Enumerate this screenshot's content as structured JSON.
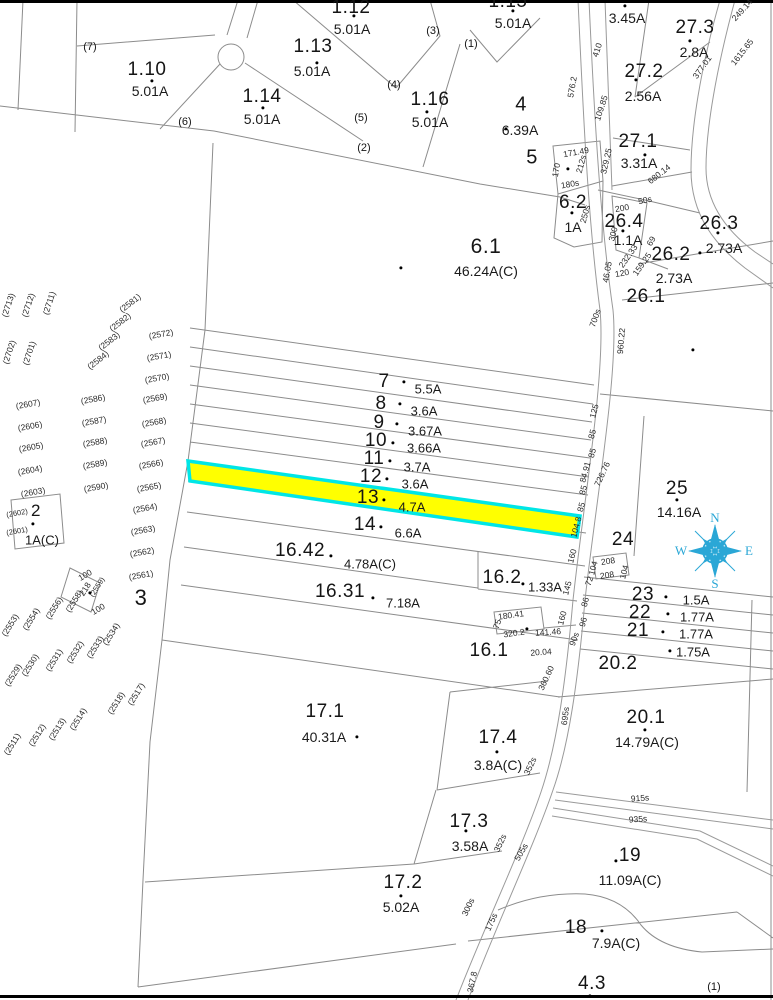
{
  "colors": {
    "highlight_fill": "#ffff00",
    "highlight_stroke": "#00e6e6",
    "compass": "#2aa7d6",
    "line": "#8c8c8c",
    "frame": "#000000"
  },
  "highlight": {
    "parcel": "13",
    "acreage": "4.7A"
  },
  "compass": {
    "n": "N",
    "e": "E",
    "s": "S",
    "w": "W"
  },
  "labels": {
    "parcels": [
      {
        "t": "1.10",
        "x": 147,
        "y": 70
      },
      {
        "t": "1.13",
        "x": 313,
        "y": 47
      },
      {
        "t": "1.12",
        "x": 351,
        "y": 8
      },
      {
        "t": "1.14",
        "x": 262,
        "y": 97
      },
      {
        "t": "1.16",
        "x": 430,
        "y": 100
      },
      {
        "t": "1.15",
        "x": 508,
        "y": 2
      },
      {
        "t": "4",
        "x": 521,
        "y": 105,
        "s": 20
      },
      {
        "t": "5",
        "x": 532,
        "y": 158,
        "s": 20
      },
      {
        "t": "27.3",
        "x": 695,
        "y": 28
      },
      {
        "t": "27.2",
        "x": 644,
        "y": 72
      },
      {
        "t": "27.1",
        "x": 638,
        "y": 142
      },
      {
        "t": "6.2",
        "x": 573,
        "y": 203
      },
      {
        "t": "26.4",
        "x": 624,
        "y": 222
      },
      {
        "t": "26.3",
        "x": 719,
        "y": 224
      },
      {
        "t": "26.2",
        "x": 671,
        "y": 255
      },
      {
        "t": "26.1",
        "x": 646,
        "y": 297
      },
      {
        "t": "6.1",
        "x": 486,
        "y": 247,
        "s": 21
      },
      {
        "t": "7",
        "x": 384,
        "y": 382
      },
      {
        "t": "8",
        "x": 381,
        "y": 404
      },
      {
        "t": "9",
        "x": 379,
        "y": 423
      },
      {
        "t": "10",
        "x": 376,
        "y": 441
      },
      {
        "t": "11",
        "x": 374,
        "y": 459
      },
      {
        "t": "12",
        "x": 371,
        "y": 477
      },
      {
        "t": "13",
        "x": 368,
        "y": 498
      },
      {
        "t": "14",
        "x": 365,
        "y": 525
      },
      {
        "t": "16.42",
        "x": 300,
        "y": 551
      },
      {
        "t": "16.31",
        "x": 340,
        "y": 592
      },
      {
        "t": "16.2",
        "x": 502,
        "y": 578
      },
      {
        "t": "16.1",
        "x": 489,
        "y": 651
      },
      {
        "t": "25",
        "x": 677,
        "y": 489
      },
      {
        "t": "24",
        "x": 623,
        "y": 540
      },
      {
        "t": "23",
        "x": 643,
        "y": 595
      },
      {
        "t": "22",
        "x": 640,
        "y": 613
      },
      {
        "t": "21",
        "x": 638,
        "y": 631
      },
      {
        "t": "20.2",
        "x": 618,
        "y": 664
      },
      {
        "t": "20.1",
        "x": 646,
        "y": 718
      },
      {
        "t": "17.1",
        "x": 325,
        "y": 712
      },
      {
        "t": "17.4",
        "x": 498,
        "y": 738
      },
      {
        "t": "17.3",
        "x": 469,
        "y": 822
      },
      {
        "t": "17.2",
        "x": 403,
        "y": 883
      },
      {
        "t": "19",
        "x": 630,
        "y": 856
      },
      {
        "t": "18",
        "x": 576,
        "y": 928
      },
      {
        "t": "4.3",
        "x": 592,
        "y": 984
      },
      {
        "t": "2",
        "x": 36,
        "y": 511,
        "s": 17
      },
      {
        "t": "3",
        "x": 141,
        "y": 598,
        "s": 22
      }
    ],
    "acreages": [
      {
        "t": "5.01A",
        "x": 150,
        "y": 91
      },
      {
        "t": "5.01A",
        "x": 312,
        "y": 71
      },
      {
        "t": "5.01A",
        "x": 352,
        "y": 29
      },
      {
        "t": "5.01A",
        "x": 262,
        "y": 119
      },
      {
        "t": "5.01A",
        "x": 430,
        "y": 122
      },
      {
        "t": "5.01A",
        "x": 513,
        "y": 23
      },
      {
        "t": "6.39A",
        "x": 520,
        "y": 130
      },
      {
        "t": "3.45A",
        "x": 627,
        "y": 18
      },
      {
        "t": "2.8A",
        "x": 694,
        "y": 52
      },
      {
        "t": "2.56A",
        "x": 643,
        "y": 96
      },
      {
        "t": "3.31A",
        "x": 639,
        "y": 163
      },
      {
        "t": "1A",
        "x": 573,
        "y": 227
      },
      {
        "t": "1.1A",
        "x": 628,
        "y": 240
      },
      {
        "t": "2.73A",
        "x": 724,
        "y": 248
      },
      {
        "t": "2.73A",
        "x": 674,
        "y": 278
      },
      {
        "t": "46.24A(C)",
        "x": 486,
        "y": 271
      },
      {
        "t": "5.5A",
        "x": 428,
        "y": 389,
        "s": 13
      },
      {
        "t": "3.6A",
        "x": 424,
        "y": 411,
        "s": 13
      },
      {
        "t": "3.67A",
        "x": 425,
        "y": 431,
        "s": 13
      },
      {
        "t": "3.66A",
        "x": 424,
        "y": 448,
        "s": 13
      },
      {
        "t": "3.7A",
        "x": 417,
        "y": 467,
        "s": 13
      },
      {
        "t": "3.6A",
        "x": 415,
        "y": 484,
        "s": 13
      },
      {
        "t": "4.7A",
        "x": 412,
        "y": 507,
        "s": 13
      },
      {
        "t": "6.6A",
        "x": 408,
        "y": 533,
        "s": 13
      },
      {
        "t": "4.78A(C)",
        "x": 370,
        "y": 564,
        "s": 13
      },
      {
        "t": "7.18A",
        "x": 403,
        "y": 603,
        "s": 13
      },
      {
        "t": "1.33A",
        "x": 545,
        "y": 587,
        "s": 13
      },
      {
        "t": "14.16A",
        "x": 679,
        "y": 512
      },
      {
        "t": "1.5A",
        "x": 696,
        "y": 600,
        "s": 13
      },
      {
        "t": "1.77A",
        "x": 697,
        "y": 617,
        "s": 13
      },
      {
        "t": "1.77A",
        "x": 696,
        "y": 634,
        "s": 13
      },
      {
        "t": "1.75A",
        "x": 693,
        "y": 652,
        "s": 13
      },
      {
        "t": "14.79A(C)",
        "x": 647,
        "y": 742
      },
      {
        "t": "40.31A",
        "x": 324,
        "y": 737
      },
      {
        "t": "3.8A(C)",
        "x": 498,
        "y": 765
      },
      {
        "t": "3.58A",
        "x": 470,
        "y": 846
      },
      {
        "t": "5.02A",
        "x": 401,
        "y": 907
      },
      {
        "t": "11.09A(C)",
        "x": 630,
        "y": 880
      },
      {
        "t": "7.9A(C)",
        "x": 616,
        "y": 943
      },
      {
        "t": "1A(C)",
        "x": 42,
        "y": 540,
        "s": 13
      }
    ],
    "sublots": [
      {
        "t": "(7)",
        "x": 90,
        "y": 47
      },
      {
        "t": "(6)",
        "x": 185,
        "y": 122
      },
      {
        "t": "(5)",
        "x": 361,
        "y": 118
      },
      {
        "t": "(4)",
        "x": 394,
        "y": 85
      },
      {
        "t": "(3)",
        "x": 433,
        "y": 31
      },
      {
        "t": "(2)",
        "x": 364,
        "y": 148
      },
      {
        "t": "(1)",
        "x": 471,
        "y": 44
      },
      {
        "t": "(1)",
        "x": 714,
        "y": 987
      }
    ],
    "refs": [
      {
        "t": "(2713)",
        "x": 8,
        "y": 305,
        "r": -72
      },
      {
        "t": "(2712)",
        "x": 28,
        "y": 305,
        "r": -72
      },
      {
        "t": "(2711)",
        "x": 49,
        "y": 303,
        "r": -72
      },
      {
        "t": "(2702)",
        "x": 9,
        "y": 352,
        "r": -72
      },
      {
        "t": "(2701)",
        "x": 29,
        "y": 353,
        "r": -72
      },
      {
        "t": "(2581)",
        "x": 130,
        "y": 303,
        "r": -38
      },
      {
        "t": "(2582)",
        "x": 120,
        "y": 322,
        "r": -38
      },
      {
        "t": "(2583)",
        "x": 109,
        "y": 341,
        "r": -38
      },
      {
        "t": "(2584)",
        "x": 98,
        "y": 360,
        "r": -38
      },
      {
        "t": "(2572)",
        "x": 161,
        "y": 334,
        "r": -10
      },
      {
        "t": "(2571)",
        "x": 159,
        "y": 356,
        "r": -10
      },
      {
        "t": "(2570)",
        "x": 157,
        "y": 378,
        "r": -10
      },
      {
        "t": "(2607)",
        "x": 28,
        "y": 404,
        "r": -10
      },
      {
        "t": "(2606)",
        "x": 30,
        "y": 426,
        "r": -10
      },
      {
        "t": "(2605)",
        "x": 31,
        "y": 447,
        "r": -10
      },
      {
        "t": "(2604)",
        "x": 30,
        "y": 470,
        "r": -10
      },
      {
        "t": "(2603)",
        "x": 33,
        "y": 492,
        "r": -10
      },
      {
        "t": "(2586)",
        "x": 93,
        "y": 399,
        "r": -10
      },
      {
        "t": "(2587)",
        "x": 94,
        "y": 421,
        "r": -10
      },
      {
        "t": "(2588)",
        "x": 95,
        "y": 442,
        "r": -10
      },
      {
        "t": "(2589)",
        "x": 95,
        "y": 464,
        "r": -10
      },
      {
        "t": "(2590)",
        "x": 96,
        "y": 487,
        "r": -10
      },
      {
        "t": "(2569)",
        "x": 155,
        "y": 398,
        "r": -10
      },
      {
        "t": "(2568)",
        "x": 154,
        "y": 422,
        "r": -10
      },
      {
        "t": "(2567)",
        "x": 153,
        "y": 442,
        "r": -10
      },
      {
        "t": "(2566)",
        "x": 151,
        "y": 464,
        "r": -10
      },
      {
        "t": "(2565)",
        "x": 149,
        "y": 487,
        "r": -10
      },
      {
        "t": "(2564)",
        "x": 145,
        "y": 508,
        "r": -10
      },
      {
        "t": "(2563)",
        "x": 143,
        "y": 530,
        "r": -10
      },
      {
        "t": "(2562)",
        "x": 142,
        "y": 552,
        "r": -10
      },
      {
        "t": "(2561)",
        "x": 141,
        "y": 575,
        "r": -10
      },
      {
        "t": "(2602)",
        "x": 17,
        "y": 513,
        "r": -10,
        "s": 7.5
      },
      {
        "t": "(2601)",
        "x": 17,
        "y": 531,
        "r": -10,
        "s": 7.5
      },
      {
        "t": "(2553)",
        "x": 10,
        "y": 625,
        "r": -58
      },
      {
        "t": "(2554)",
        "x": 31,
        "y": 619,
        "r": -58
      },
      {
        "t": "(2556)",
        "x": 54,
        "y": 608,
        "r": -58
      },
      {
        "t": "(2558)",
        "x": 74,
        "y": 601,
        "r": -58
      },
      {
        "t": "(2559)",
        "x": 97,
        "y": 587,
        "r": -58,
        "s": 7.5
      },
      {
        "t": "(2534)",
        "x": 111,
        "y": 634,
        "r": -58
      },
      {
        "t": "(2533)",
        "x": 95,
        "y": 647,
        "r": -58
      },
      {
        "t": "(2532)",
        "x": 75,
        "y": 652,
        "r": -58
      },
      {
        "t": "(2531)",
        "x": 54,
        "y": 660,
        "r": -58
      },
      {
        "t": "(2530)",
        "x": 30,
        "y": 665,
        "r": -58
      },
      {
        "t": "(2529)",
        "x": 13,
        "y": 675,
        "r": -58
      },
      {
        "t": "(2517)",
        "x": 136,
        "y": 694,
        "r": -58
      },
      {
        "t": "(2518)",
        "x": 116,
        "y": 703,
        "r": -58
      },
      {
        "t": "(2514)",
        "x": 78,
        "y": 719,
        "r": -58
      },
      {
        "t": "(2513)",
        "x": 57,
        "y": 729,
        "r": -58
      },
      {
        "t": "(2512)",
        "x": 37,
        "y": 735,
        "r": -58
      },
      {
        "t": "(2511)",
        "x": 12,
        "y": 744,
        "r": -58
      }
    ],
    "measurements": [
      {
        "t": "410",
        "x": 597,
        "y": 50,
        "r": -72
      },
      {
        "t": "576.2",
        "x": 572,
        "y": 87,
        "r": -80
      },
      {
        "t": "109.85",
        "x": 601,
        "y": 108,
        "r": -72
      },
      {
        "t": "329.25",
        "x": 606,
        "y": 161,
        "r": -77
      },
      {
        "t": "377.01",
        "x": 702,
        "y": 67,
        "r": -55
      },
      {
        "t": "1615.65",
        "x": 742,
        "y": 52,
        "r": -52
      },
      {
        "t": "249.14",
        "x": 742,
        "y": 10,
        "r": -48
      },
      {
        "t": "680.14",
        "x": 659,
        "y": 174,
        "r": -38
      },
      {
        "t": "171.49",
        "x": 576,
        "y": 152,
        "r": -10
      },
      {
        "t": "170",
        "x": 556,
        "y": 170,
        "r": -80
      },
      {
        "t": "212s",
        "x": 581,
        "y": 164,
        "r": -75
      },
      {
        "t": "180s",
        "x": 570,
        "y": 184,
        "r": -10
      },
      {
        "t": "50s",
        "x": 645,
        "y": 200,
        "r": -12
      },
      {
        "t": "200",
        "x": 622,
        "y": 208,
        "r": -10
      },
      {
        "t": "250s",
        "x": 585,
        "y": 214,
        "r": -75
      },
      {
        "t": "300",
        "x": 613,
        "y": 234,
        "r": -75
      },
      {
        "t": "232.33",
        "x": 628,
        "y": 256,
        "r": -55
      },
      {
        "t": "120",
        "x": 622,
        "y": 273,
        "r": -10
      },
      {
        "t": "159.25",
        "x": 642,
        "y": 264,
        "r": -55
      },
      {
        "t": "69",
        "x": 651,
        "y": 241,
        "r": -60
      },
      {
        "t": "46.05",
        "x": 607,
        "y": 272,
        "r": -80
      },
      {
        "t": "700s",
        "x": 595,
        "y": 318,
        "r": -70
      },
      {
        "t": "960.22",
        "x": 621,
        "y": 341,
        "r": -85
      },
      {
        "t": "125",
        "x": 594,
        "y": 411,
        "r": -75
      },
      {
        "t": "85",
        "x": 592,
        "y": 434,
        "r": -75
      },
      {
        "t": "85",
        "x": 592,
        "y": 453,
        "r": -75
      },
      {
        "t": "84.91",
        "x": 585,
        "y": 472,
        "r": -75
      },
      {
        "t": "85",
        "x": 583,
        "y": 490,
        "r": -75
      },
      {
        "t": "85",
        "x": 581,
        "y": 507,
        "r": -75
      },
      {
        "t": "104.8",
        "x": 576,
        "y": 527,
        "r": -75
      },
      {
        "t": "160",
        "x": 572,
        "y": 556,
        "r": -75
      },
      {
        "t": "726.76",
        "x": 602,
        "y": 474,
        "r": -65
      },
      {
        "t": "145",
        "x": 567,
        "y": 588,
        "r": -75
      },
      {
        "t": "160",
        "x": 562,
        "y": 618,
        "r": -75
      },
      {
        "t": "90s",
        "x": 574,
        "y": 639,
        "r": -70
      },
      {
        "t": "72",
        "x": 589,
        "y": 581,
        "r": -70
      },
      {
        "t": "86",
        "x": 585,
        "y": 602,
        "r": -75
      },
      {
        "t": "96",
        "x": 583,
        "y": 622,
        "r": -75
      },
      {
        "t": "208",
        "x": 608,
        "y": 561,
        "r": -8
      },
      {
        "t": "104",
        "x": 593,
        "y": 568,
        "r": -75
      },
      {
        "t": "208",
        "x": 607,
        "y": 575,
        "r": -8
      },
      {
        "t": "104",
        "x": 624,
        "y": 572,
        "r": -75
      },
      {
        "t": "180.41",
        "x": 511,
        "y": 615,
        "r": -8
      },
      {
        "t": "75",
        "x": 497,
        "y": 624,
        "r": -70
      },
      {
        "t": "320.2",
        "x": 514,
        "y": 633,
        "r": -8
      },
      {
        "t": "141.46",
        "x": 548,
        "y": 632,
        "r": -4
      },
      {
        "t": "20.04",
        "x": 541,
        "y": 652,
        "r": -4
      },
      {
        "t": "695s",
        "x": 565,
        "y": 716,
        "r": -82
      },
      {
        "t": "915s",
        "x": 640,
        "y": 798,
        "r": -4
      },
      {
        "t": "935s",
        "x": 638,
        "y": 819,
        "r": -4
      },
      {
        "t": "360.60",
        "x": 546,
        "y": 678,
        "r": -65
      },
      {
        "t": "352s",
        "x": 530,
        "y": 766,
        "r": -65
      },
      {
        "t": "352s",
        "x": 500,
        "y": 843,
        "r": -65
      },
      {
        "t": "505s",
        "x": 521,
        "y": 852,
        "r": -60
      },
      {
        "t": "300s",
        "x": 468,
        "y": 907,
        "r": -65
      },
      {
        "t": "175s",
        "x": 491,
        "y": 922,
        "r": -65
      },
      {
        "t": "367.8",
        "x": 472,
        "y": 982,
        "r": -78
      },
      {
        "t": "100",
        "x": 85,
        "y": 575,
        "r": -30
      },
      {
        "t": "218",
        "x": 85,
        "y": 589,
        "r": -58
      },
      {
        "t": "100",
        "x": 98,
        "y": 609,
        "r": -30
      }
    ]
  },
  "dots": [
    [
      152,
      81
    ],
    [
      317,
      63
    ],
    [
      354,
      16
    ],
    [
      263,
      108
    ],
    [
      427,
      112
    ],
    [
      513,
      11
    ],
    [
      506,
      129
    ],
    [
      625,
      6
    ],
    [
      690,
      41
    ],
    [
      636,
      80
    ],
    [
      645,
      155
    ],
    [
      572,
      213
    ],
    [
      568,
      169
    ],
    [
      623,
      231
    ],
    [
      718,
      233
    ],
    [
      700,
      253
    ],
    [
      693,
      350
    ],
    [
      401,
      268
    ],
    [
      404,
      382
    ],
    [
      400,
      404
    ],
    [
      397,
      424
    ],
    [
      393,
      443
    ],
    [
      390,
      461
    ],
    [
      387,
      479
    ],
    [
      384,
      500
    ],
    [
      381,
      527
    ],
    [
      331,
      556
    ],
    [
      373,
      598
    ],
    [
      523,
      584
    ],
    [
      527,
      629
    ],
    [
      33,
      524
    ],
    [
      90,
      593
    ],
    [
      677,
      500
    ],
    [
      666,
      597
    ],
    [
      668,
      614
    ],
    [
      663,
      632
    ],
    [
      670,
      651
    ],
    [
      645,
      730
    ],
    [
      357,
      737
    ],
    [
      497,
      752
    ],
    [
      466,
      831
    ],
    [
      401,
      896
    ],
    [
      616,
      861
    ],
    [
      602,
      931
    ],
    [
      590,
      996
    ]
  ]
}
